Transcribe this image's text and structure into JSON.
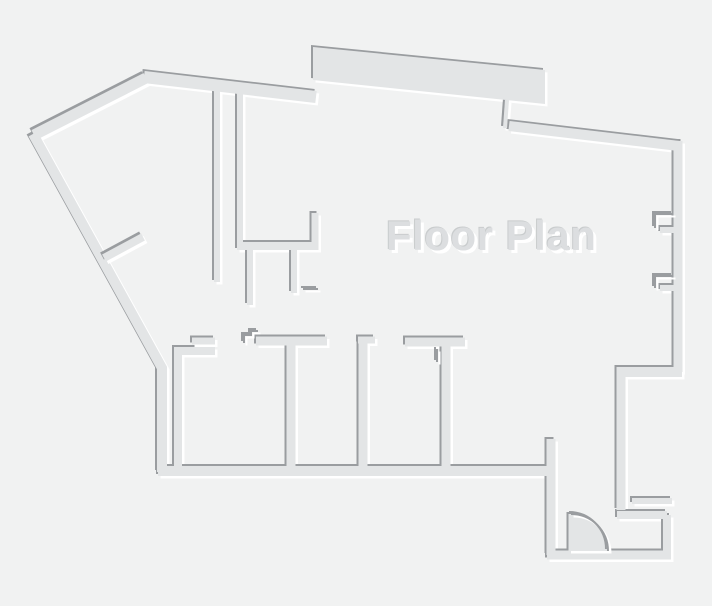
{
  "title": {
    "text": "Floor Plan"
  },
  "colors": {
    "background": "#f1f2f2",
    "wall": "#e3e5e6",
    "edge_dark": "#9a9da0",
    "highlight": "#ffffff",
    "title_fill": "#dcdee0",
    "title_edge": "#c9cccd"
  },
  "canvas": {
    "width": 712,
    "height": 606
  },
  "floor_plan": {
    "filled_shapes": [
      {
        "name": "top-band-wall",
        "d": "M313,47 L545,70 L545,104 L313,80 Z"
      }
    ],
    "walls": [
      {
        "name": "outer-top-left-diagonal-wall",
        "d": "M34,135 L146,78",
        "w": 11
      },
      {
        "name": "outer-top-wall",
        "d": "M144,77 L316,97",
        "w": 12
      },
      {
        "name": "band-connector-wall",
        "d": "M507,100 L505,128",
        "w": 4
      },
      {
        "name": "outer-top-right-wall",
        "d": "M509,126 L679,146",
        "w": 10
      },
      {
        "name": "outer-right-wall",
        "d": "M678,141 L678,372",
        "w": 9
      },
      {
        "name": "right-step-horizontal-wall",
        "d": "M682,372 L617,372",
        "w": 10
      },
      {
        "name": "right-step-vertical-wall",
        "d": "M621,367 L621,510",
        "w": 9
      },
      {
        "name": "entry-outer-stub-wall",
        "d": "M632,501 L672,501",
        "w": 6
      },
      {
        "name": "entry-inner-horizontal-wall",
        "d": "M617,515 L667,515",
        "w": 8
      },
      {
        "name": "entry-right-wall",
        "d": "M667,515 L667,555",
        "w": 8
      },
      {
        "name": "entry-bottom-wall",
        "d": "M547,555 L671,555",
        "w": 9
      },
      {
        "name": "entry-left-wall",
        "d": "M551,439 L551,555",
        "w": 9
      },
      {
        "name": "outer-bottom-wall",
        "d": "M158,471 L552,471",
        "w": 10
      },
      {
        "name": "outer-left-wall",
        "d": "M33,134 L162,368 L162,472",
        "w": 10
      },
      {
        "name": "hall-long-wall",
        "d": "M217,86 L217,282",
        "w": 6
      },
      {
        "name": "closet-left-wall",
        "d": "M240,88 L240,246",
        "w": 6
      },
      {
        "name": "closet-bottom-wall",
        "d": "M237,246 L318,246",
        "w": 8
      },
      {
        "name": "closet-right-stub-wall",
        "d": "M315,213 L315,250",
        "w": 7
      },
      {
        "name": "stub-below-closet-wall",
        "d": "M250,249 L250,305",
        "w": 6
      },
      {
        "name": "l-stub-wall",
        "d": "M294,250 L294,293",
        "w": 6
      },
      {
        "name": "room1-left-wall",
        "d": "M178,347 L178,470",
        "w": 8
      },
      {
        "name": "room1-top-wall",
        "d": "M174,351 L215,351",
        "w": 8
      },
      {
        "name": "corridor-top-wall",
        "d": "M256,341 L327,341",
        "w": 9
      },
      {
        "name": "room-divider-1-wall",
        "d": "M291,341 L291,470",
        "w": 9
      },
      {
        "name": "room-divider-2-cap-wall",
        "d": "M358,340 L375,340",
        "w": 7
      },
      {
        "name": "room-divider-2-wall",
        "d": "M363,340 L363,470",
        "w": 9
      },
      {
        "name": "room-divider-3-bar-wall",
        "d": "M405,342 L465,342",
        "w": 9
      },
      {
        "name": "room-divider-3-stem-wall",
        "d": "M446,342 L446,470",
        "w": 9
      },
      {
        "name": "window-sill-stub-1",
        "d": "M660,230 L674,230",
        "w": 6
      },
      {
        "name": "window-sill-stub-2",
        "d": "M660,288 L674,288",
        "w": 6
      }
    ],
    "overlays": [
      {
        "name": "left-door-leaf",
        "d": "M104,258 L143,237",
        "w": 8
      },
      {
        "name": "room1-door-leaf",
        "d": "M192,341 L215,341",
        "w": 7
      },
      {
        "name": "entry-door-leaf",
        "d": "M571,514 L571,551",
        "w": 5
      }
    ],
    "overlay_shapes": [
      {
        "name": "entry-door-swing",
        "d": "M571,514 A37,37 0 0 1 608,551 L571,551 Z"
      }
    ],
    "thin_marks": [
      {
        "name": "door-jog-mark",
        "d": "M244,343 L244,335 L251,335 L251,331 L258,331"
      },
      {
        "name": "divider-3-hinge-tick",
        "d": "M437,349 L437,362"
      },
      {
        "name": "stub-foot-mark",
        "d": "M303,289 L318,289"
      },
      {
        "name": "window-notch-1",
        "d": "M673,214 L655,214 L655,228"
      },
      {
        "name": "window-notch-2",
        "d": "M673,276 L655,276 L655,288"
      },
      {
        "name": "entry-door-arc-line",
        "d": "M571,514 A37,37 0 0 1 608,551"
      }
    ]
  }
}
